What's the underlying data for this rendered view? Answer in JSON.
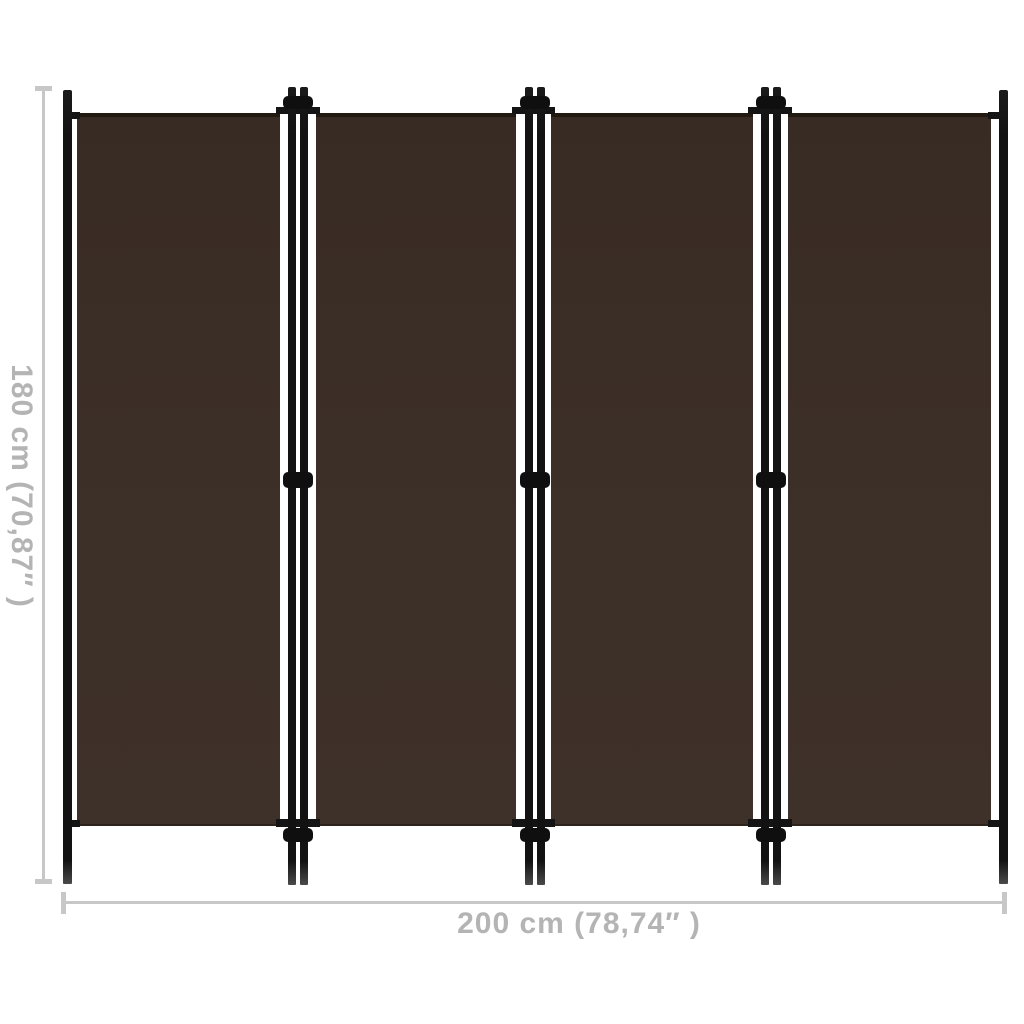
{
  "page": {
    "background_color": "#ffffff",
    "description": "Product dimension diagram of a brown 4-panel folding room divider screen"
  },
  "divider": {
    "panel_count": 4,
    "fabric_color": "#3c2f27",
    "frame_color": "#141414"
  },
  "dimensions": {
    "height_label": "180 cm (70,87″ )",
    "width_label": "200 cm (78,74″ )",
    "line_color": "#c7c7c7",
    "text_color": "#b4b4b4"
  }
}
